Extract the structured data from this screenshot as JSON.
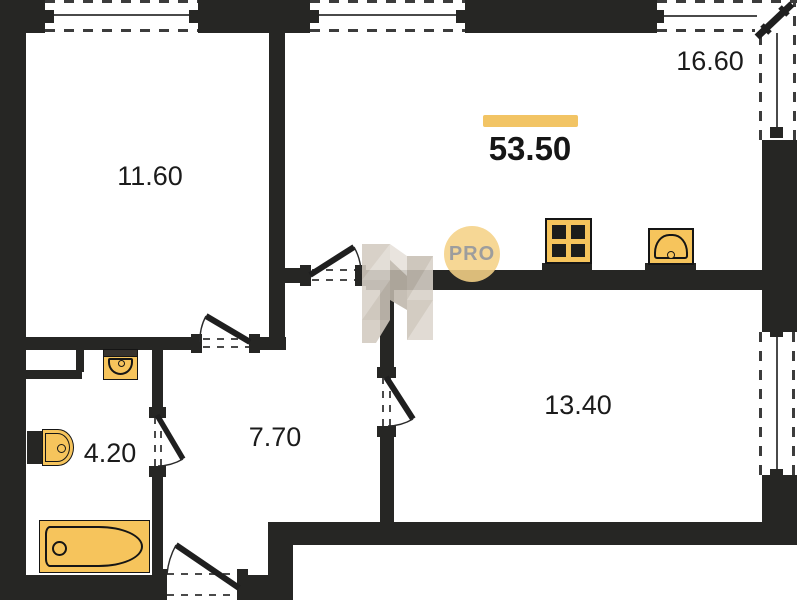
{
  "plan": {
    "total_area": "53.50",
    "logo_text": "PRO",
    "rooms": {
      "bedroom_top_left": {
        "area": "11.60"
      },
      "kitchen_living": {
        "area": "16.60"
      },
      "bedroom_right": {
        "area": "13.40"
      },
      "hallway": {
        "area": "7.70"
      },
      "bathroom": {
        "area": "4.20"
      }
    },
    "icons": {
      "stove": "stove-icon",
      "kitchen_sink": "kitchen-sink-icon",
      "bathroom_sink": "bathroom-sink-icon",
      "toilet": "toilet-icon",
      "bathtub": "bathtub-icon",
      "logo": "pro-logo-badge",
      "watermark": "developer-watermark-logo"
    },
    "colors": {
      "wall": "#262624",
      "accent_bar": "#F2C464",
      "fixture_fill": "#F6C45C",
      "logo_circle": "#F5D186",
      "watermark": "#D8D1C8",
      "text": "#1b1b1b"
    }
  }
}
